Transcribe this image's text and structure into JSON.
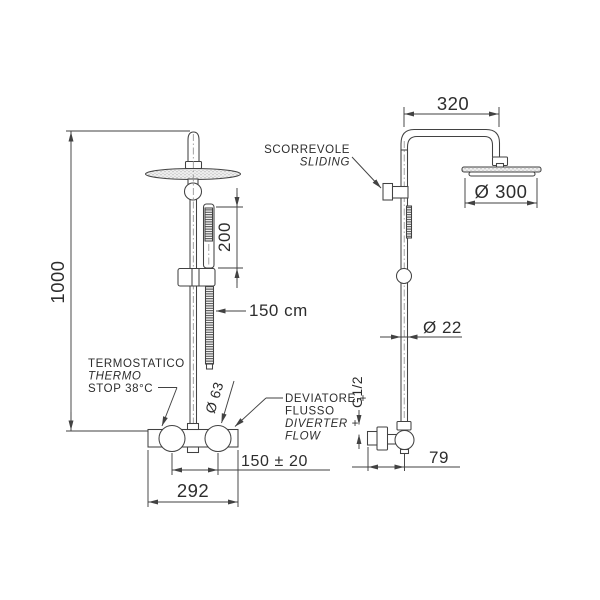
{
  "front_view": {
    "total_height": "1000",
    "handshower_length": "200",
    "hose_length": "150 cm",
    "thermostatic_label": [
      "TERMOSTATICO",
      "THERMO",
      "STOP 38°C"
    ],
    "knob_diameter": "Ø 63",
    "diverter_label": [
      "DEVIATORE +",
      "FLUSSO",
      "DIVERTER +",
      "FLOW"
    ],
    "inlet_spacing": "150 ± 20",
    "body_width": "292"
  },
  "side_view": {
    "arm_reach": "320",
    "head_diameter": "Ø 300",
    "slider_label": [
      "SCORREVOLE",
      "SLIDING"
    ],
    "pipe_diameter": "Ø 22",
    "thread_size": "G1/2",
    "wall_distance": "79"
  },
  "style": {
    "line_color": "#424242",
    "text_color": "#2d2d2d",
    "background": "#ffffff"
  }
}
